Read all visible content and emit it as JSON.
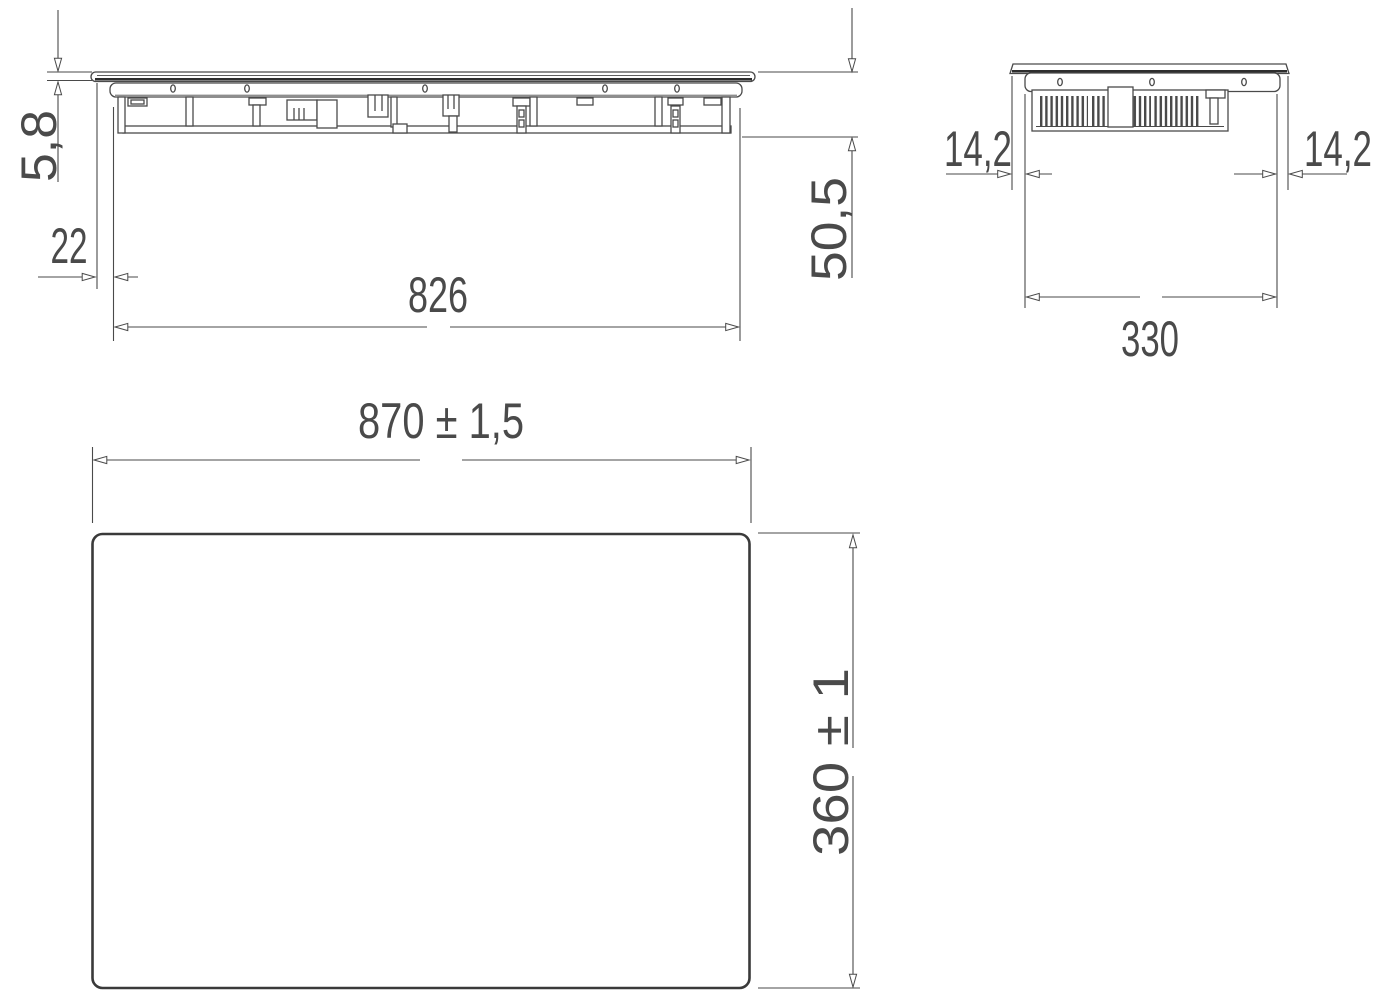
{
  "drawing": {
    "background": "#ffffff",
    "line_color": "#4a4a4a",
    "heavy_line_color": "#2e2e2e",
    "plan_outline_color": "#3a3a3a",
    "text_color": "#4a4a4a",
    "front_view": {
      "dimensions": {
        "glass_thickness": "5,8",
        "glass_overhang": "22",
        "body_width": "826",
        "overall_height": "50,5"
      }
    },
    "side_view": {
      "dimensions": {
        "overhang_left": "14,2",
        "overhang_right": "14,2",
        "body_depth": "330"
      }
    },
    "top_view": {
      "dimensions": {
        "overall_width": "870 ± 1,5",
        "overall_depth": "360 ± 1"
      }
    }
  }
}
